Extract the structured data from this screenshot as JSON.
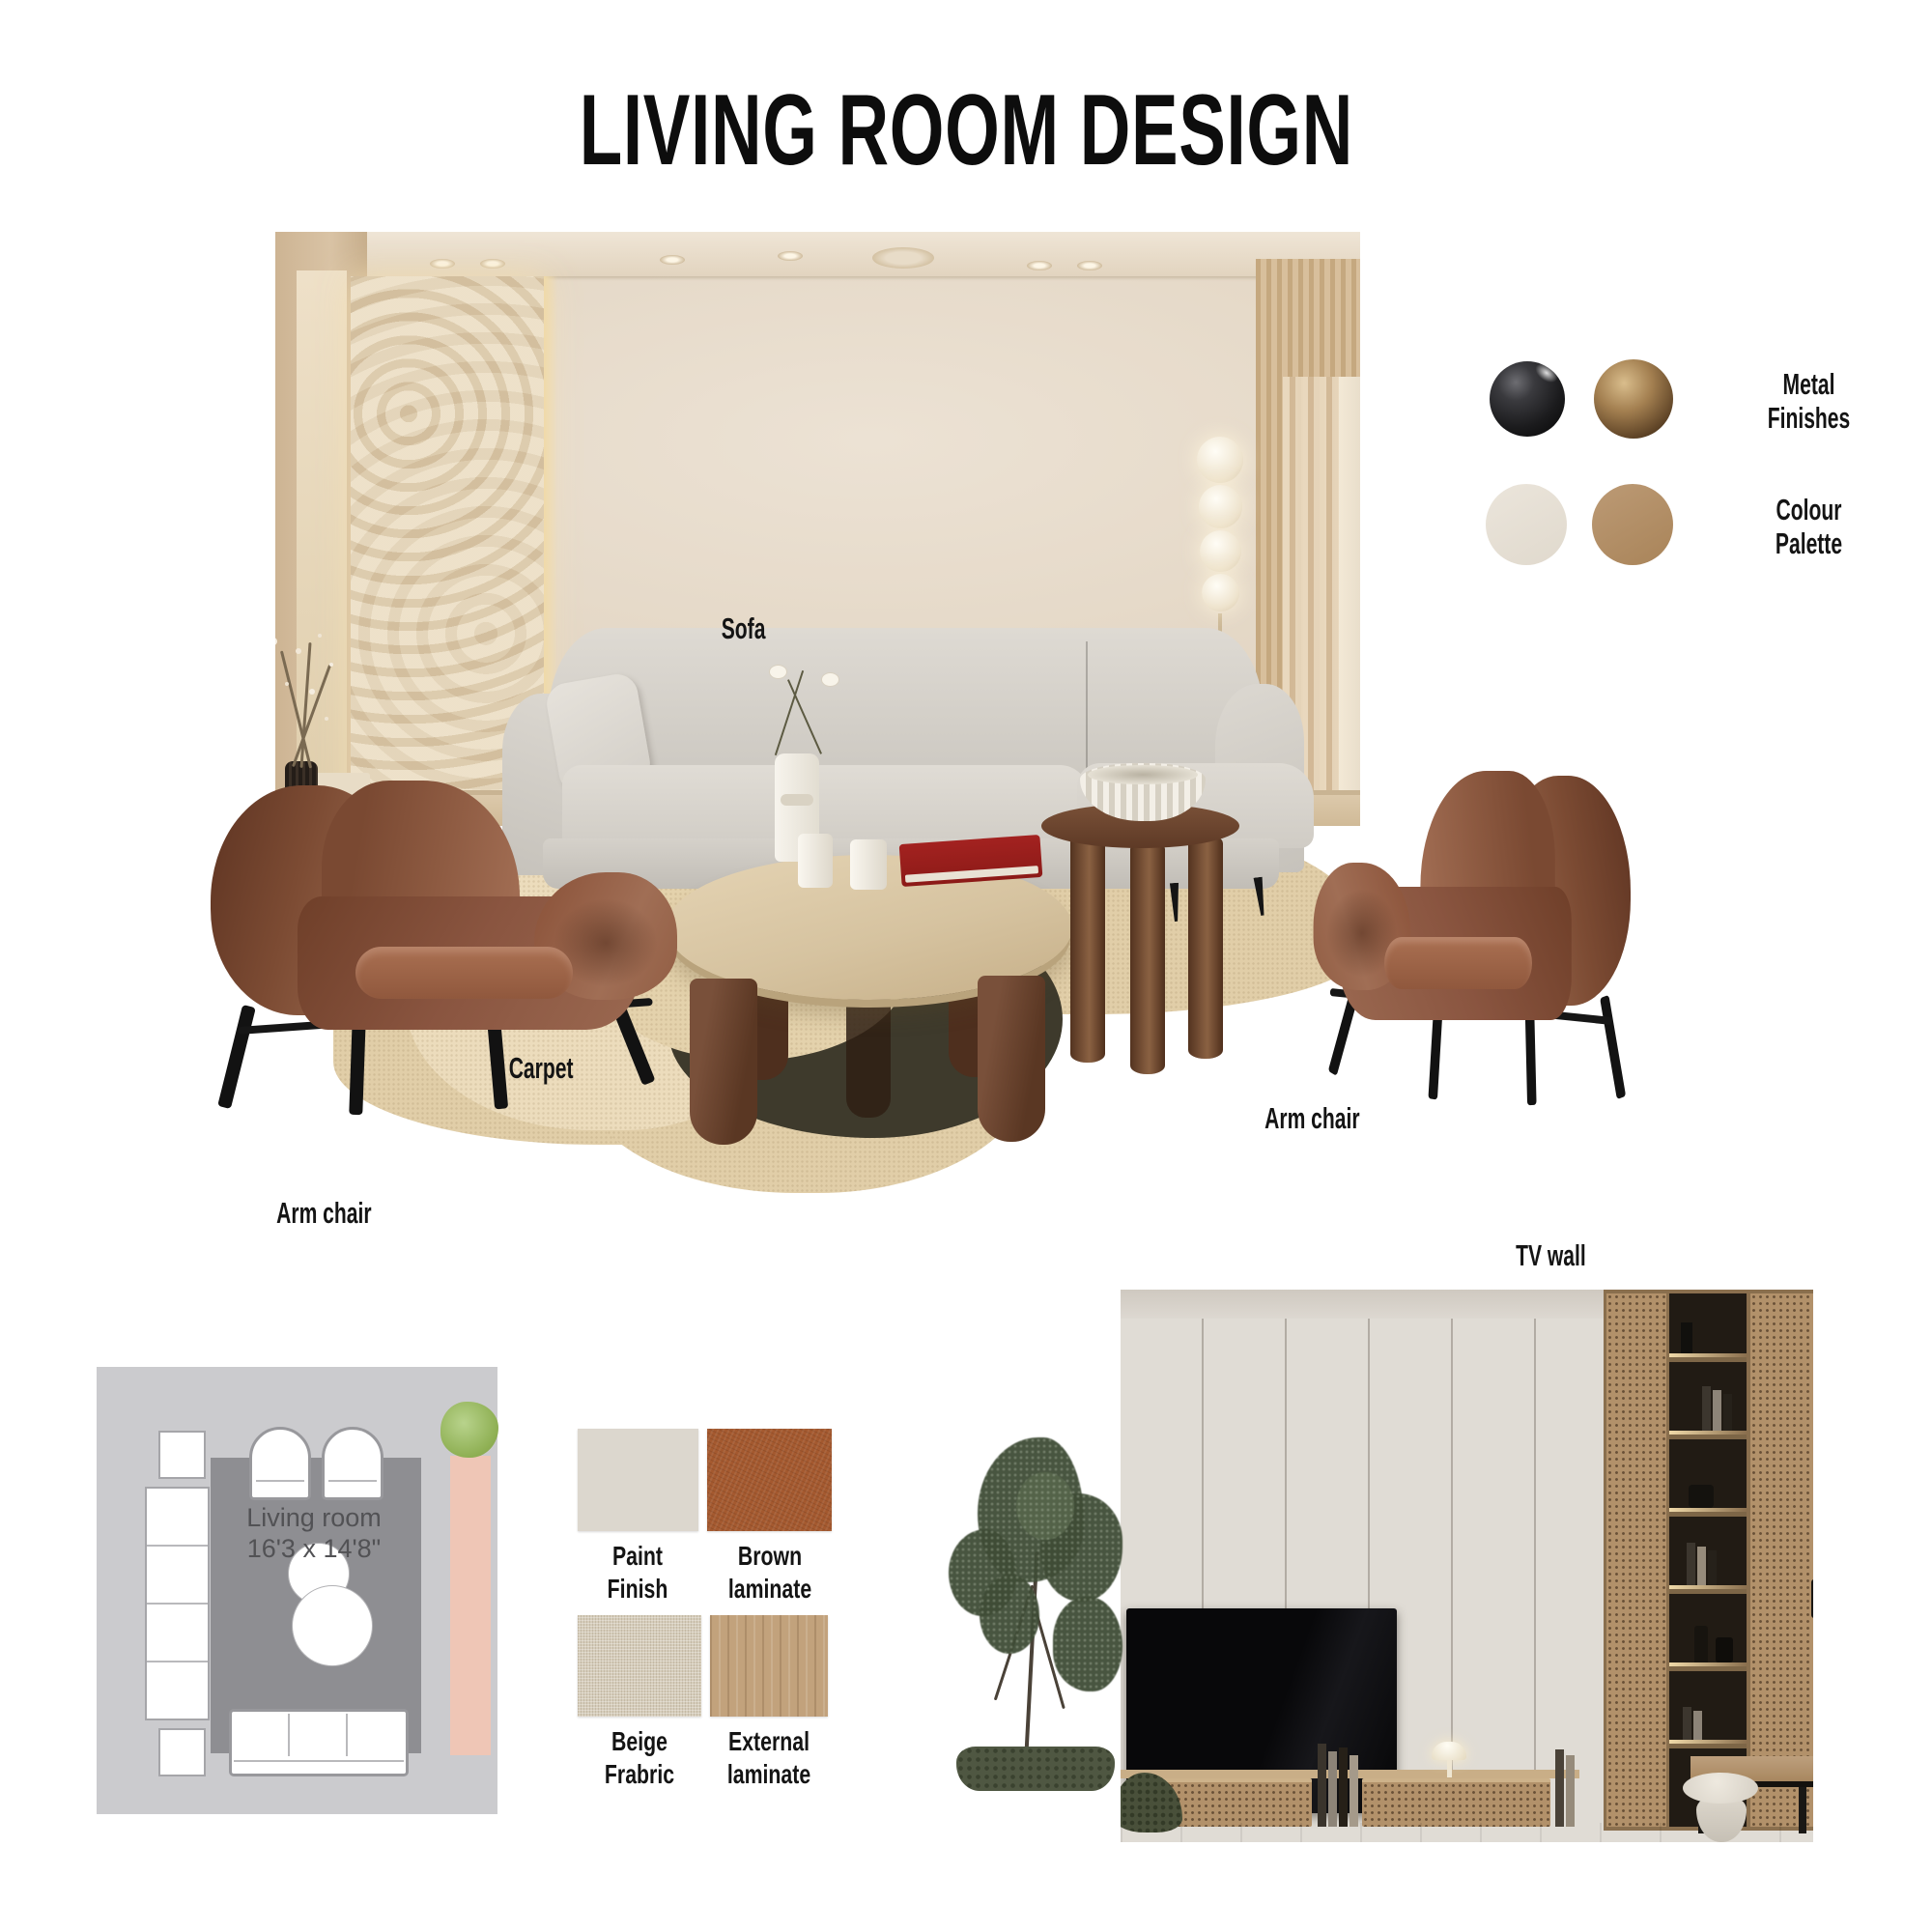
{
  "title": "LIVING ROOM DESIGN",
  "annotations": {
    "sofa": "Sofa",
    "carpet": "Carpet",
    "arm_chair_left": "Arm chair",
    "arm_chair_right": "Arm chair",
    "tv_wall": "TV wall"
  },
  "metal_finishes": {
    "label_line1": "Metal",
    "label_line2": "Finishes",
    "swatches": [
      {
        "name": "matte-black",
        "color": "#1d1d1f"
      },
      {
        "name": "bronze",
        "color": "#7b5f3d"
      }
    ]
  },
  "colour_palette": {
    "label_line1": "Colour",
    "label_line2": "Palette",
    "swatches": [
      {
        "name": "cream",
        "color": "#e8e2d8"
      },
      {
        "name": "camel",
        "color": "#b3906a"
      }
    ]
  },
  "floor_plan": {
    "room_name": "Living room",
    "dimensions": "16'3 x 14'8\""
  },
  "materials": [
    {
      "line1": "Paint",
      "line2": "Finish",
      "color": "#dcd7ce"
    },
    {
      "line1": "Brown",
      "line2": "laminate",
      "color": "#a4592f"
    },
    {
      "line1": "Beige",
      "line2": "Frabric",
      "color": "#d6cdbb"
    },
    {
      "line1": "External",
      "line2": "laminate",
      "color": "#c2a27c"
    }
  ]
}
